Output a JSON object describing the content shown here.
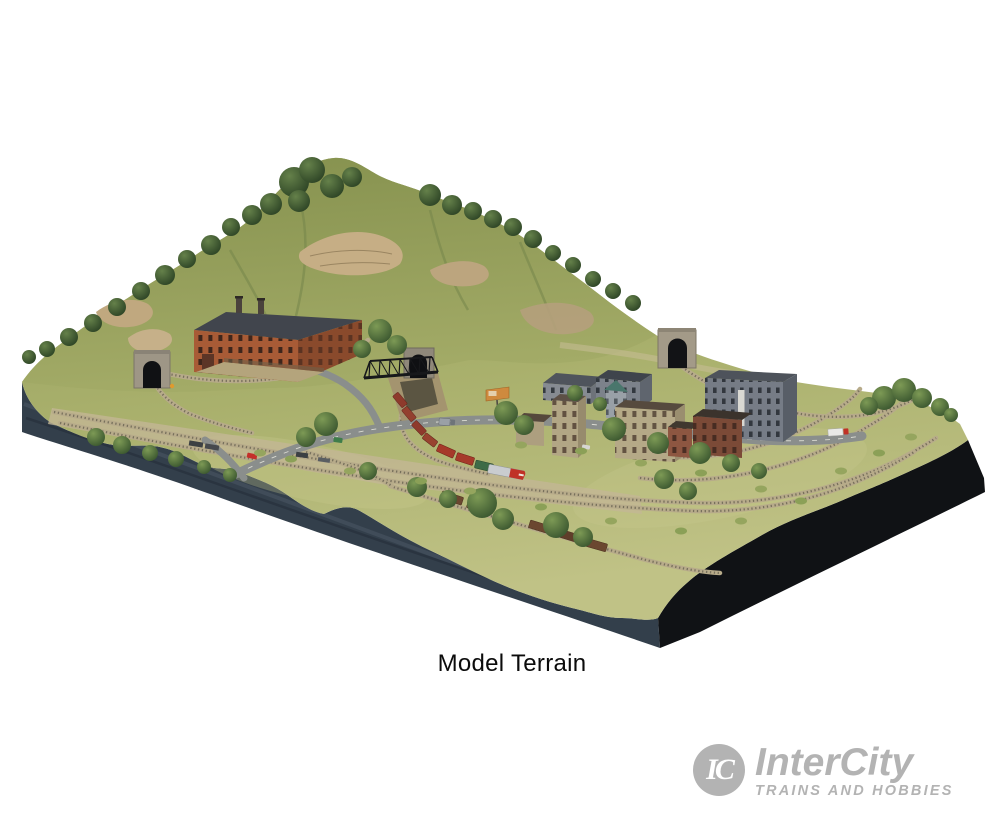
{
  "page": {
    "background_color": "#ffffff"
  },
  "caption": {
    "text": "Model Terrain"
  },
  "brand": {
    "monogram": "IC",
    "name": "InterCity",
    "tagline": "TRAINS AND HOBBIES",
    "color": "#b3b3b3"
  },
  "photo": {
    "description": "Product photo of a model railroad terrain diorama: a grassy hill with rock outcrops and trees, three stone tunnel portals, a brick factory, a town of brick and concrete buildings, curving roads with cars and trucks, a black steel truss bridge over a ravine, freight trains on looping track, all on a thick dark display base over a white background.",
    "colors": {
      "grass": "#a9b06c",
      "hill_rock": "#c6ae85",
      "tree": "#3c5830",
      "base_side_left": "#333f4b",
      "base_side_right": "#101215",
      "road": "#8a8e8c",
      "track_ballast": "#b7ab8a",
      "factory_brick": "#a85b36",
      "town_gray": "#767c86",
      "locomotive_red": "#c03227",
      "boxcar_green": "#3e6b47",
      "boxcar_brown": "#6b4730"
    }
  }
}
